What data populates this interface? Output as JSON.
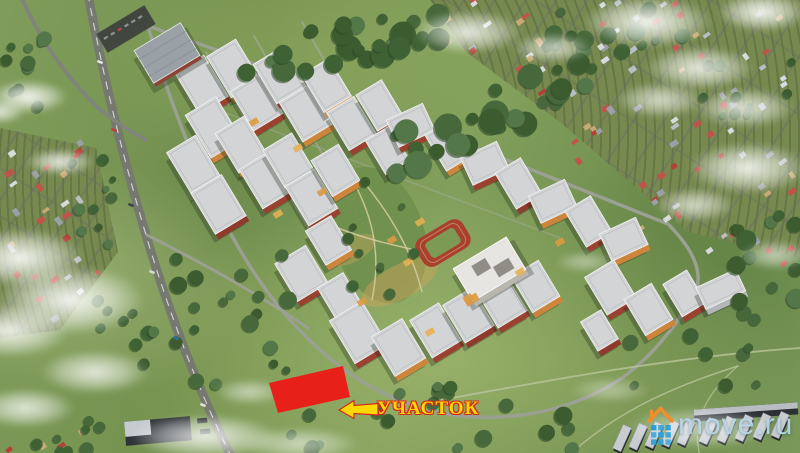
{
  "scene": {
    "type": "aerial-3d-render",
    "subject": "residential complex master plan among green fields with highlighted land plot for sale",
    "palette": {
      "grass": "#7c9857",
      "grass_light": "#9db269",
      "forest_green": "#3f5f33",
      "road_grey": "#75796f",
      "minor_road_grey": "#9aa092",
      "roof_grey": "#d2d4d5",
      "facade_colors": [
        "#9a4130",
        "#cd853c",
        "#8e3a2c",
        "#dda04a",
        "#a34b33",
        "#b3b7b9"
      ],
      "plot_red": "#e7211a",
      "school_white": "#e6e5e1",
      "track_red": "#a8402c",
      "warehouse_roof": "#c7ccd1",
      "warehouse_dark": "#23282c"
    }
  },
  "annotation": {
    "label": "УЧАСТОК",
    "label_color": "#ffd800",
    "label_outline_color": "#d3281c",
    "arrow_icon": "left-arrow"
  },
  "watermark": {
    "text": "move.ru",
    "text_color": "rgba(187,217,235,0.92)",
    "house_roof_color": "#ef8f2c",
    "pixel_grid_color": "#2aa0d8",
    "icon": "move-ru-house-logo"
  }
}
